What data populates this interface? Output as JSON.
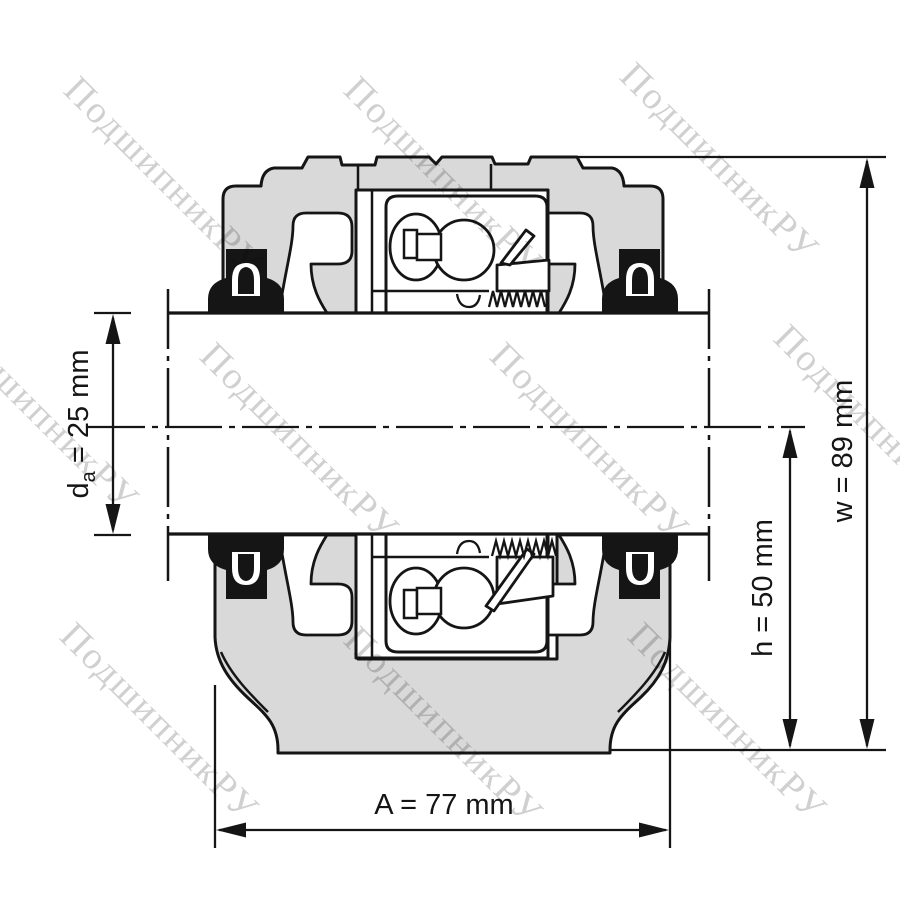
{
  "watermark": {
    "text": "ПодшипникРУ"
  },
  "dimensions": {
    "da": {
      "base": "d",
      "sub": "a",
      "rest": " = 25 mm",
      "full": "da = 25 mm"
    },
    "h": {
      "text": "h = 50 mm"
    },
    "w": {
      "text": "w = 89 mm"
    },
    "A": {
      "text": "A = 77 mm"
    }
  },
  "colors": {
    "housing": "#d9d9d9",
    "line": "#151515",
    "watermark": "#d0d0d0",
    "background": "#ffffff"
  }
}
